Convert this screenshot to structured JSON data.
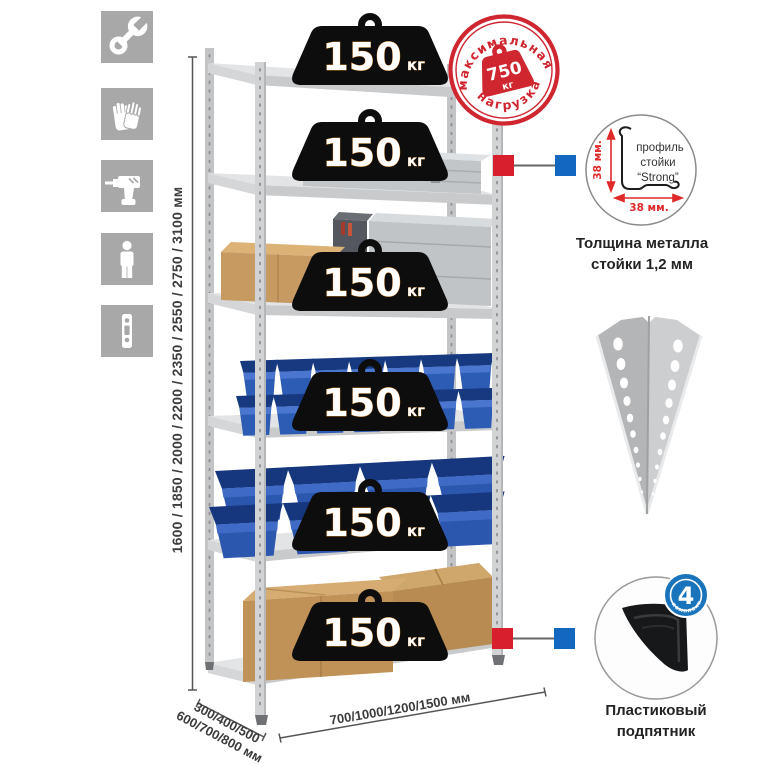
{
  "title": "Metal shelving rack product diagram",
  "left_icons": {
    "items": [
      {
        "name": "wrench"
      },
      {
        "name": "gloves"
      },
      {
        "name": "drill"
      },
      {
        "name": "person"
      },
      {
        "name": "rack-post"
      }
    ]
  },
  "height_dimension": {
    "label": "1600 / 1850 / 2000 / 2200 / 2350 / 2550 / 2750 / 3100 мм"
  },
  "depth_dimension": {
    "line1": "300/400/500",
    "line2": "600/700/800 мм"
  },
  "width_dimension": {
    "label": "700/1000/1200/1500 мм"
  },
  "shelves": {
    "count": 6,
    "load_badge": {
      "value": "150",
      "unit": "кг"
    }
  },
  "max_load_stamp": {
    "arc_top": "максимальная",
    "arc_bottom": "нагрузка",
    "value": "750",
    "unit": "кг",
    "color": "#cf2630"
  },
  "profile_detail": {
    "label_line1": "профиль",
    "label_line2": "стойки",
    "label_line3": "“Strong”",
    "dim_vertical": "38 мм.",
    "dim_horizontal": "38 мм.",
    "caption_line1": "Толщина металла",
    "caption_line2": "стойки 1,2 мм"
  },
  "foot_detail": {
    "badge_value": "4",
    "badge_arc": "в комплекте",
    "badge_color": "#1a74bc",
    "caption_line1": "Пластиковый",
    "caption_line2": "подпятник"
  },
  "colors": {
    "accent_red": "#d71f2e",
    "accent_blue": "#1467bf",
    "bin_blue": "#2d5cb5",
    "icon_gray": "#a8a8a8",
    "metal_gray": "#cbccce"
  }
}
